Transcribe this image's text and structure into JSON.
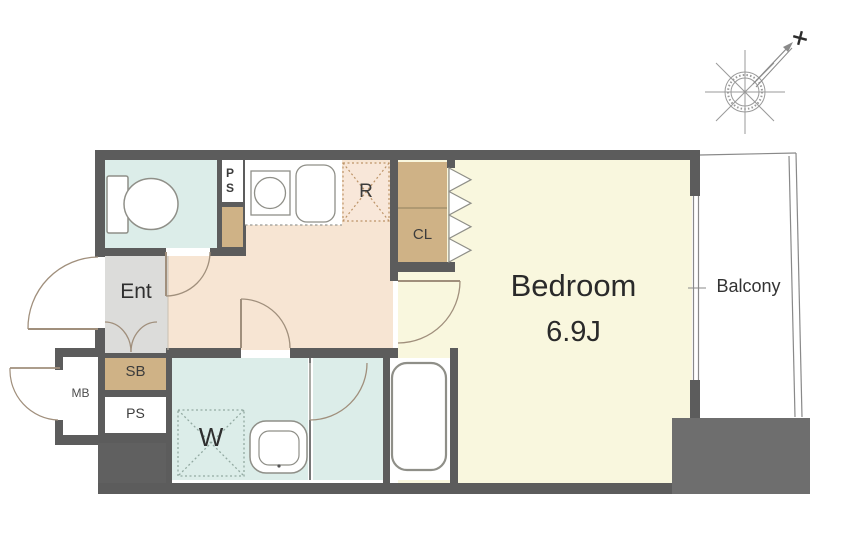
{
  "rooms": {
    "bedroom": {
      "label": "Bedroom",
      "size": "6.9J"
    },
    "balcony": {
      "label": "Balcony"
    },
    "entrance": {
      "label": "Ent"
    },
    "closet": {
      "label": "CL"
    },
    "refrigerator_space": {
      "label": "R"
    },
    "washer_space": {
      "label": "W"
    },
    "shoe_box": {
      "label": "SB"
    },
    "pipe_space_upper": {
      "label": "PS"
    },
    "pipe_space_lower": {
      "label": "PS"
    },
    "meter_box": {
      "label": "MB"
    }
  },
  "compass": {
    "type": "compass-rose",
    "north_marker": "+"
  },
  "colors": {
    "wall": "#5c5c5c",
    "block_bottom_right": "#6e6e6e",
    "bedroom_floor": "#f9f7de",
    "kitchen_floor": "#f7e5d3",
    "wet_area_floor": "#dcede9",
    "entrance_floor": "#dcdcda",
    "storage_tan": "#cfb286",
    "door_arc": "#a08f7c",
    "fixture_outline": "#8f8f88"
  }
}
